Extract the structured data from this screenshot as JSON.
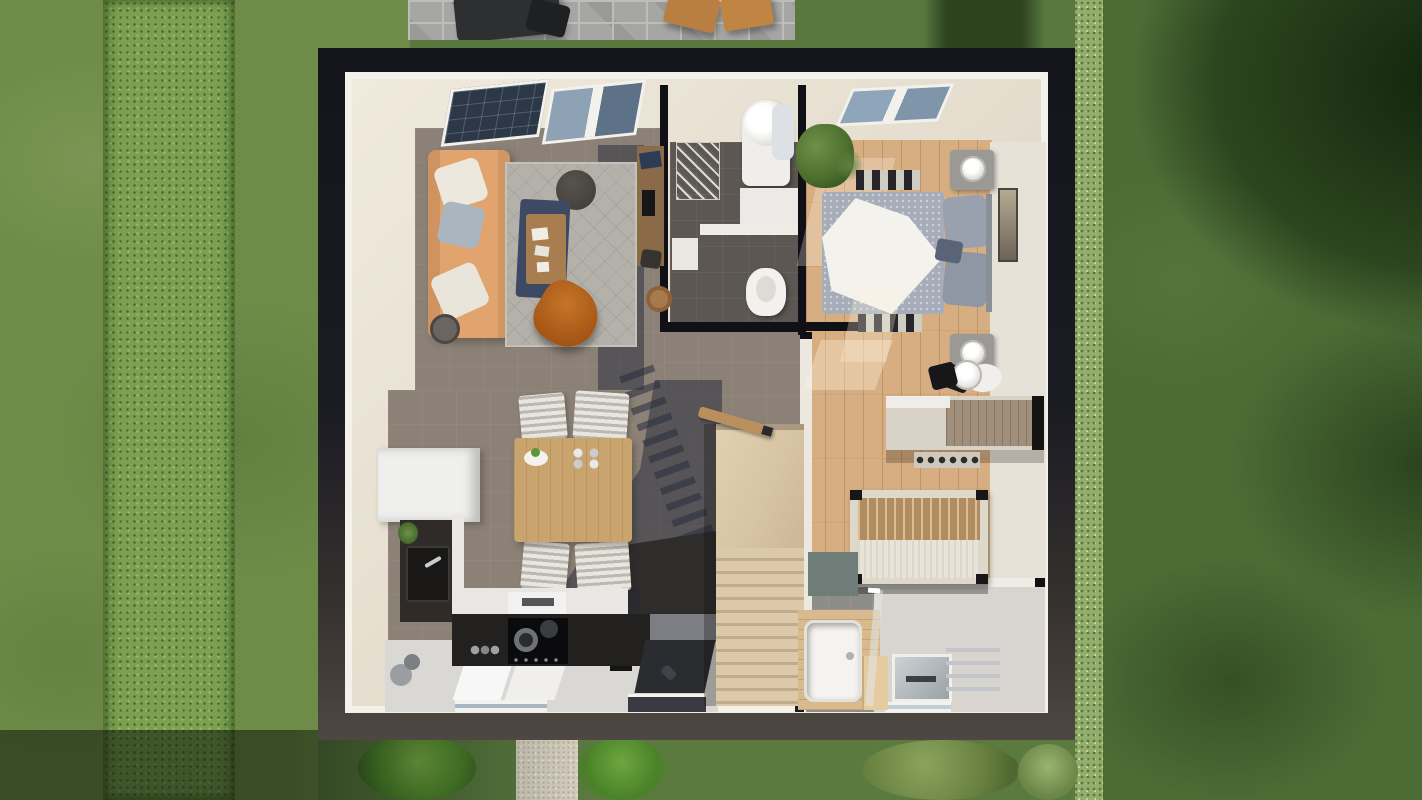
{
  "scene": {
    "type": "architectural-3d-floorplan-render",
    "view": "top-down cutaway of a single-storey house interior surrounded by lawn",
    "palette": {
      "lawn_left": "#6e8b48",
      "hedge_left": "#7ba050",
      "lawn_right": "#4c6c35",
      "tree_canopy_shadow": "#16290f",
      "hedge_right": "#93ad6c",
      "patio_pavers": "#a6a6a4",
      "garden_path": "#d8d1c2",
      "roof_edge_dark": "#1b1b23",
      "roof_edge_light": "#4e4742",
      "wall_cut_white": "#f4f1eb",
      "wall_face_cream": "#e6dfd0",
      "floor_taupe": "#8b8176",
      "floor_wood_oak": "#d6ae82",
      "floor_tile_dark": "#5c5752",
      "floor_white": "#d9d8d4",
      "rug_gray": "#b4b1aa",
      "sofa_tan": "#e1a46f",
      "leather_chair_cognac": "#b5651d",
      "textile_navy": "#3e4a64",
      "duvet_gray": "#a6adb8",
      "stairs_wood": "#dcc9a9",
      "kitchen_counter_dark": "#232120",
      "dining_table_wood": "#c9a46e",
      "tub_surround_wood": "#d8ba8e",
      "shadow_blue": "rgba(38,44,60,0.52)"
    },
    "exterior": {
      "elements": [
        {
          "name": "lawn-left",
          "note": "light mown grass"
        },
        {
          "name": "hedge-row-left",
          "note": "vertical bushy strip"
        },
        {
          "name": "lawn-right",
          "note": "darker grass under tree canopy shadow"
        },
        {
          "name": "hedge-row-right",
          "note": "runs along right house edge"
        },
        {
          "name": "patio",
          "furniture": [
            "dark-bistro-table",
            "black-chair",
            "wooden-chair",
            "wooden-chair"
          ]
        },
        {
          "name": "garden-path",
          "note": "gravel path from front door to bottom edge"
        },
        {
          "name": "bushes",
          "count": 4
        },
        {
          "name": "ground-shadow-bottom-left"
        }
      ]
    },
    "house": {
      "rooms": [
        {
          "name": "living-room",
          "floor": "taupe",
          "furniture": [
            "tan-sofa",
            "three-pillows",
            "gray-rug",
            "round-pouf",
            "navy-blanket",
            "wood-coffee-table",
            "books",
            "leather-butterfly-chair",
            "side-table",
            "two-roof-windows"
          ]
        },
        {
          "name": "hallway-desk-nook",
          "floor": "taupe",
          "furniture": [
            "wall-desk",
            "laptop",
            "stool",
            "chair"
          ]
        },
        {
          "name": "utility-wc",
          "floor": "dark-tile",
          "furniture": [
            "water-heater-cylinder",
            "towels",
            "drying-rack",
            "washer-counter",
            "shelf",
            "toilet"
          ]
        },
        {
          "name": "master-bedroom",
          "floor": "oak",
          "furniture": [
            "double-bed-gray-duvet",
            "white-throw",
            "pillows",
            "two-nightstands",
            "two-lamps",
            "striped-rug",
            "wall-art",
            "plant",
            "roof-window",
            "stool",
            "black-chair"
          ]
        },
        {
          "name": "dining-area",
          "floor": "taupe",
          "furniture": [
            "wood-dining-table",
            "four-striped-chairs",
            "fruit-plate",
            "cups",
            "white-cabinet"
          ]
        },
        {
          "name": "kitchen",
          "floor": "white",
          "furniture": [
            "dark-l-counter",
            "sink",
            "faucet",
            "cooktop",
            "pots",
            "extractor",
            "plant",
            "kettle",
            "black-shelf"
          ]
        },
        {
          "name": "staircase",
          "floor": "wood",
          "furniture": [
            "landing",
            "steps",
            "railing-bar",
            "railing-shadow-stripes"
          ]
        },
        {
          "name": "entry",
          "floor": "white",
          "furniture": [
            "doormat",
            "front-door"
          ]
        },
        {
          "name": "second-bedroom",
          "floor": "oak",
          "furniture": [
            "slatted-bed-frame",
            "desk",
            "shelf-bar",
            "drum-lamp",
            "black-chair",
            "shoe-shelf"
          ]
        },
        {
          "name": "bathroom",
          "floor": "white-and-gray-tile",
          "furniture": [
            "wood-clad-bathtub",
            "step",
            "glass-screen",
            "shower-recess",
            "towel-radiator",
            "teal-tile-patch"
          ]
        }
      ]
    }
  }
}
